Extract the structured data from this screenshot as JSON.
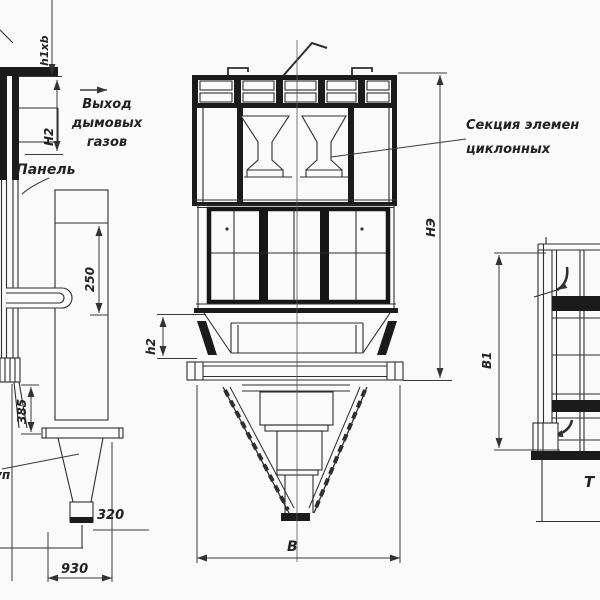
{
  "colors": {
    "background": "#fafafa",
    "line": "#333333",
    "ink": "#1b1b1b"
  },
  "views": {
    "left": {
      "labels": {
        "h1xb": "h1xb",
        "H2": "H2",
        "flue_gas_outlet": "Выход\nдымовых\nгазов",
        "panel": "Панель",
        "dim_250": "250",
        "dim_385": "385",
        "dim_320": "320",
        "dim_930": "930",
        "edge_fragment": "уп"
      }
    },
    "front": {
      "labels": {
        "dim_h2": "h2",
        "dim_B": "В",
        "dim_NE": "НЭ",
        "cyclone_section": "Секция элемен\nциклонных"
      }
    },
    "side": {
      "labels": {
        "dim_B1": "В1",
        "partial_T": "Т"
      }
    }
  }
}
